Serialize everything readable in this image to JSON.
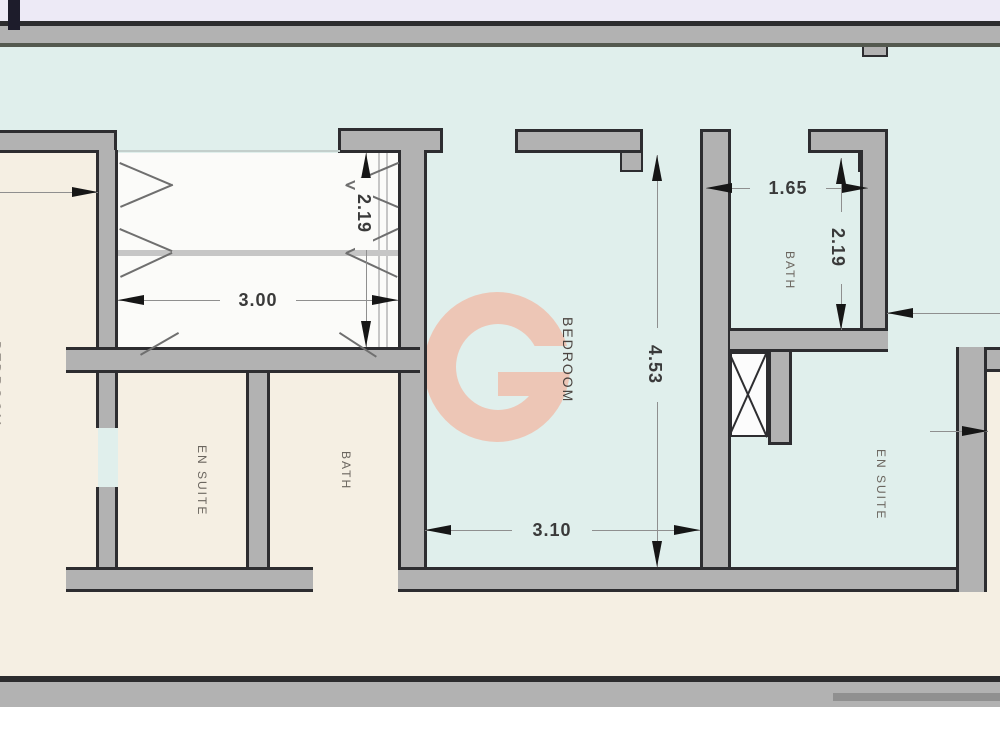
{
  "plan": {
    "type": "floor-plan",
    "watermark_letter": "G",
    "colors": {
      "top_band": "#edeaf6",
      "outer_line": "#2c2c2e",
      "outer_line2": "#54594f",
      "wall_fill": "#b2b2b2",
      "wall_outline": "#2d2d30",
      "room_cyan": "#e0efec",
      "room_beige": "#f5efe3",
      "closet_white": "#fbfbf9",
      "logo_salmon": "#edc6b6",
      "dim_line": "#8f8f8f",
      "arrow_color": "#161616",
      "dim_color": "#3a3a3a",
      "label_color": "#6b665f",
      "bedroom_label_color": "#4b4440",
      "bottom_inner_line": "#909090",
      "cut_mark": "#1d1c2b"
    },
    "rooms": [
      {
        "id": "left-bedroom",
        "label": "BEDROOM"
      },
      {
        "id": "en-suite-left",
        "label": "EN SUITE"
      },
      {
        "id": "bath-left",
        "label": "BATH"
      },
      {
        "id": "bedroom",
        "label": "BEDROOM"
      },
      {
        "id": "bath-right",
        "label": "BATH"
      },
      {
        "id": "en-suite-right",
        "label": "EN SUITE"
      }
    ],
    "dimensions": [
      {
        "id": "closet-width",
        "value": "3.00",
        "orientation": "horizontal"
      },
      {
        "id": "closet-depth",
        "value": "2.19",
        "orientation": "vertical"
      },
      {
        "id": "bedroom-width",
        "value": "3.10",
        "orientation": "horizontal"
      },
      {
        "id": "bedroom-depth",
        "value": "4.53",
        "orientation": "vertical"
      },
      {
        "id": "bath-width",
        "value": "1.65",
        "orientation": "horizontal"
      },
      {
        "id": "bath-depth",
        "value": "2.19",
        "orientation": "vertical"
      }
    ]
  }
}
